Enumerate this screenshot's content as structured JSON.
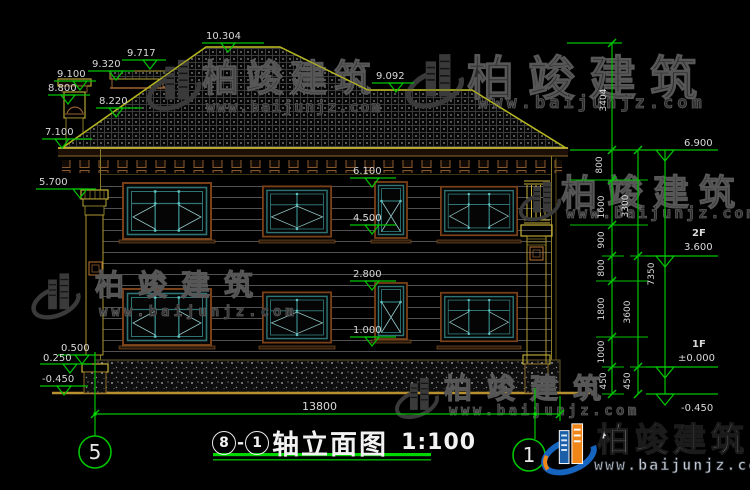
{
  "brand": {
    "name": "柏竣建筑",
    "url": "www.baijunjz.com"
  },
  "title": {
    "axis_left": "8",
    "dash": "-",
    "axis_right": "1",
    "name": "轴立面图",
    "scale": "1:100"
  },
  "grid": {
    "left_bubble": "5",
    "right_bubble": "1"
  },
  "levels": {
    "l10304": "10.304",
    "l9717": "9.717",
    "l9320": "9.320",
    "l9100": "9.100",
    "l8800": "8.800",
    "l8220": "8.220",
    "l7100": "7.100",
    "l5700": "5.700",
    "l9092": "9.092",
    "l6100": "6.100",
    "l4500": "4.500",
    "l2800": "2.800",
    "l1000": "1.000",
    "l0500": "0.500",
    "l0250": "0.250",
    "lm0450": "-0.450",
    "l6900": "6.900",
    "l3600": "3.600",
    "lpm0": "±0.000",
    "lm0450r": "-0.450",
    "f2": "2F",
    "f1": "1F"
  },
  "vdims": {
    "s3404": "3404",
    "s800a": "800",
    "s1600": "1600",
    "s900": "900",
    "s800b": "800",
    "s1800": "1800",
    "s1000": "1000",
    "s450a": "450",
    "t3300": "3300",
    "t3600": "3600",
    "t450": "450",
    "total": "7350"
  },
  "hdims": {
    "width": "13800"
  },
  "colors": {
    "dim_green": "#00c400",
    "roof_yellow": "#b5b520",
    "window_teal": "#2e7474",
    "frame_brown": "#7a4018",
    "logo_blue": "#1565c0",
    "logo_orange": "#f08518"
  }
}
